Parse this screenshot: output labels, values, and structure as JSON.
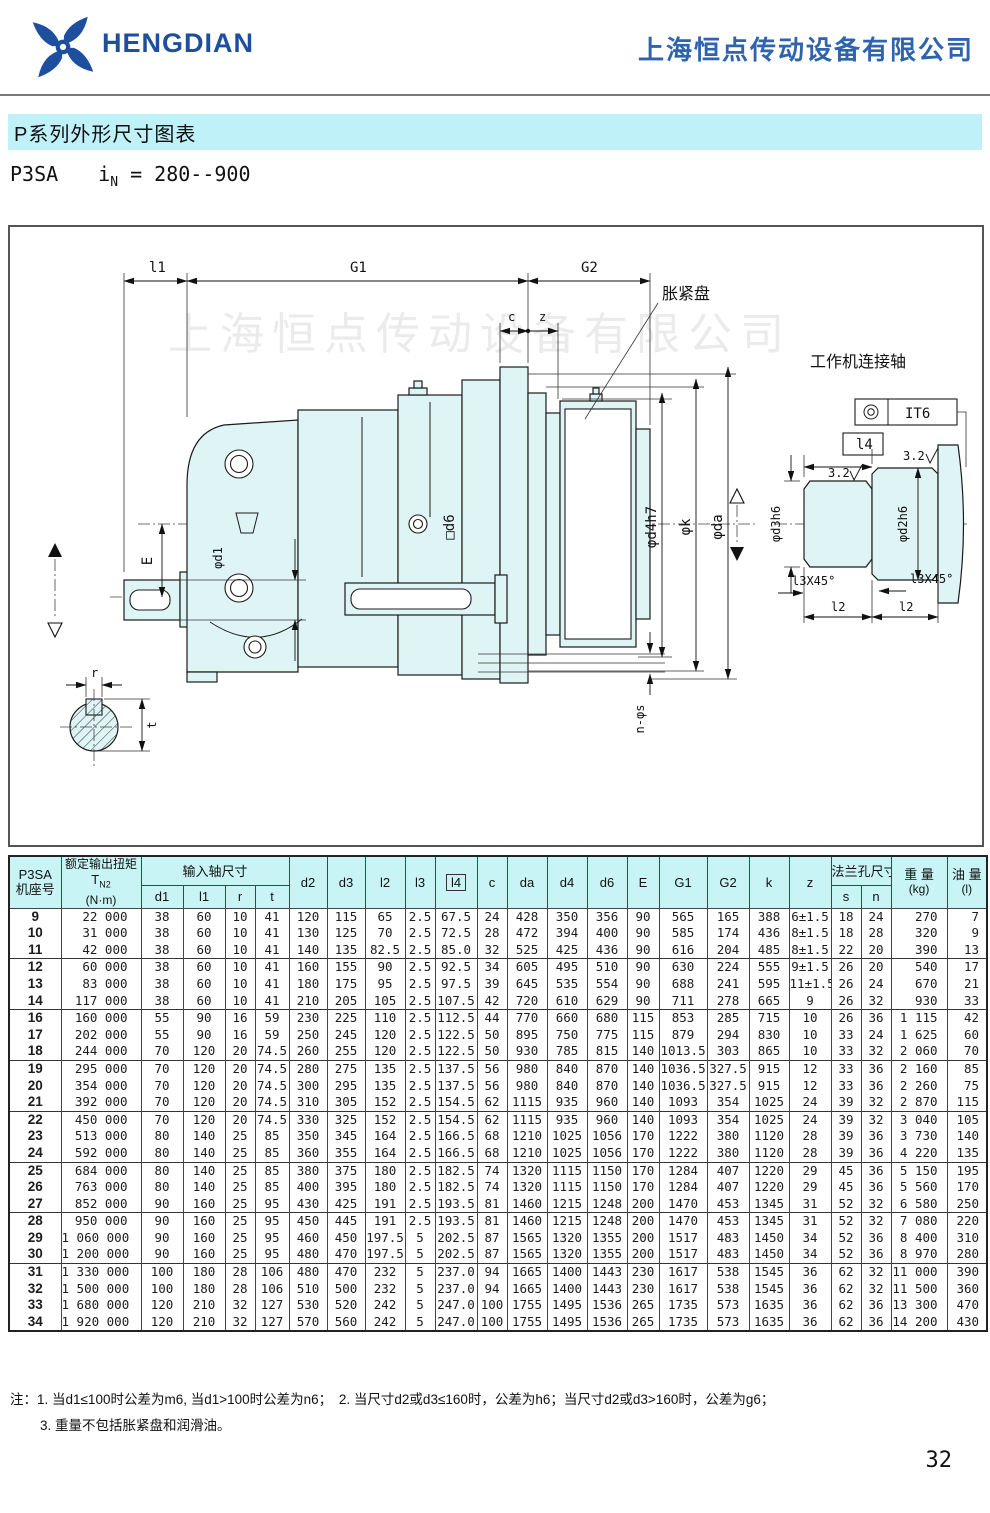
{
  "header": {
    "logo_text": "HENGDIAN",
    "company_name": "上海恒点传动设备有限公司"
  },
  "title_bar": {
    "title": "P系列外形尺寸图表"
  },
  "subtitle": {
    "model": "P3SA",
    "ratio_prefix": "i",
    "ratio_sub": "N",
    "ratio_value": "= 280--900"
  },
  "drawing": {
    "watermark": "上海恒点传动设备有限公司",
    "labels": {
      "l1": "l1",
      "G1": "G1",
      "G2": "G2",
      "c": "c",
      "z": "z",
      "expansion_disc": "胀紧盘",
      "work_shaft": "工作机连接轴",
      "E": "E",
      "d1": "φd1",
      "d6": "□d6",
      "d4h7": "φd4h7",
      "k": "φk",
      "da": "φda",
      "ns": "n-φs",
      "r": "r",
      "t": "t",
      "it6": "IT6",
      "l4": "l4",
      "rough_left": "3.2",
      "rough_right": "3.2",
      "d3h6": "φd3h6",
      "d2h6": "φd2h6",
      "chamfer_left": "l3X45°",
      "chamfer_right": "l3X45°",
      "l2_left": "l2",
      "l2_right": "l2"
    }
  },
  "table": {
    "header": {
      "col1_line1": "P3SA",
      "col1_line2": "机座号",
      "col2_line1": "额定输出扭矩",
      "col2_sym": "T",
      "col2_sub": "N2",
      "col2_unit": "(N·m)",
      "input_group": "输入轴尺寸",
      "d1": "d1",
      "l1": "l1",
      "r": "r",
      "t": "t",
      "d2": "d2",
      "d3": "d3",
      "l2": "l2",
      "l3": "l3",
      "l4": "l4",
      "c": "c",
      "da": "da",
      "d4": "d4",
      "d6": "d6",
      "E": "E",
      "G1": "G1",
      "G2": "G2",
      "k": "k",
      "z": "z",
      "flange_group": "法兰孔尺寸",
      "s": "s",
      "n": "n",
      "weight_line1": "重 量",
      "weight_line2": "(kg)",
      "oil_line1": "油 量",
      "oil_line2": "(l)"
    },
    "col_widths": [
      52,
      80,
      42,
      42,
      30,
      34,
      38,
      38,
      40,
      30,
      42,
      30,
      40,
      40,
      40,
      32,
      48,
      42,
      40,
      42,
      30,
      30,
      56,
      40
    ],
    "group_starts": [
      "9",
      "12",
      "16",
      "19",
      "22",
      "25",
      "28",
      "31"
    ],
    "rows": [
      [
        "9",
        "22 000",
        "38",
        "60",
        "10",
        "41",
        "120",
        "115",
        "65",
        "2.5",
        "67.5",
        "24",
        "428",
        "350",
        "356",
        "90",
        "565",
        "165",
        "388",
        "6±1.5",
        "18",
        "24",
        "270",
        "7"
      ],
      [
        "10",
        "31 000",
        "38",
        "60",
        "10",
        "41",
        "130",
        "125",
        "70",
        "2.5",
        "72.5",
        "28",
        "472",
        "394",
        "400",
        "90",
        "585",
        "174",
        "436",
        "8±1.5",
        "18",
        "28",
        "320",
        "9"
      ],
      [
        "11",
        "42 000",
        "38",
        "60",
        "10",
        "41",
        "140",
        "135",
        "82.5",
        "2.5",
        "85.0",
        "32",
        "525",
        "425",
        "436",
        "90",
        "616",
        "204",
        "485",
        "8±1.5",
        "22",
        "20",
        "390",
        "13"
      ],
      [
        "12",
        "60 000",
        "38",
        "60",
        "10",
        "41",
        "160",
        "155",
        "90",
        "2.5",
        "92.5",
        "34",
        "605",
        "495",
        "510",
        "90",
        "630",
        "224",
        "555",
        "9±1.5",
        "26",
        "20",
        "540",
        "17"
      ],
      [
        "13",
        "83 000",
        "38",
        "60",
        "10",
        "41",
        "180",
        "175",
        "95",
        "2.5",
        "97.5",
        "39",
        "645",
        "535",
        "554",
        "90",
        "688",
        "241",
        "595",
        "11±1.5",
        "26",
        "24",
        "670",
        "21"
      ],
      [
        "14",
        "117 000",
        "38",
        "60",
        "10",
        "41",
        "210",
        "205",
        "105",
        "2.5",
        "107.5",
        "42",
        "720",
        "610",
        "629",
        "90",
        "711",
        "278",
        "665",
        "9",
        "26",
        "32",
        "930",
        "33"
      ],
      [
        "16",
        "160 000",
        "55",
        "90",
        "16",
        "59",
        "230",
        "225",
        "110",
        "2.5",
        "112.5",
        "44",
        "770",
        "660",
        "680",
        "115",
        "853",
        "285",
        "715",
        "10",
        "26",
        "36",
        "1 115",
        "42"
      ],
      [
        "17",
        "202 000",
        "55",
        "90",
        "16",
        "59",
        "250",
        "245",
        "120",
        "2.5",
        "122.5",
        "50",
        "895",
        "750",
        "775",
        "115",
        "879",
        "294",
        "830",
        "10",
        "33",
        "24",
        "1 625",
        "60"
      ],
      [
        "18",
        "244 000",
        "70",
        "120",
        "20",
        "74.5",
        "260",
        "255",
        "120",
        "2.5",
        "122.5",
        "50",
        "930",
        "785",
        "815",
        "140",
        "1013.5",
        "303",
        "865",
        "10",
        "33",
        "32",
        "2 060",
        "70"
      ],
      [
        "19",
        "295 000",
        "70",
        "120",
        "20",
        "74.5",
        "280",
        "275",
        "135",
        "2.5",
        "137.5",
        "56",
        "980",
        "840",
        "870",
        "140",
        "1036.5",
        "327.5",
        "915",
        "12",
        "33",
        "36",
        "2 160",
        "85"
      ],
      [
        "20",
        "354 000",
        "70",
        "120",
        "20",
        "74.5",
        "300",
        "295",
        "135",
        "2.5",
        "137.5",
        "56",
        "980",
        "840",
        "870",
        "140",
        "1036.5",
        "327.5",
        "915",
        "12",
        "33",
        "36",
        "2 260",
        "75"
      ],
      [
        "21",
        "392 000",
        "70",
        "120",
        "20",
        "74.5",
        "310",
        "305",
        "152",
        "2.5",
        "154.5",
        "62",
        "1115",
        "935",
        "960",
        "140",
        "1093",
        "354",
        "1025",
        "24",
        "39",
        "32",
        "2 870",
        "115"
      ],
      [
        "22",
        "450 000",
        "70",
        "120",
        "20",
        "74.5",
        "330",
        "325",
        "152",
        "2.5",
        "154.5",
        "62",
        "1115",
        "935",
        "960",
        "140",
        "1093",
        "354",
        "1025",
        "24",
        "39",
        "32",
        "3 040",
        "105"
      ],
      [
        "23",
        "513 000",
        "80",
        "140",
        "25",
        "85",
        "350",
        "345",
        "164",
        "2.5",
        "166.5",
        "68",
        "1210",
        "1025",
        "1056",
        "170",
        "1222",
        "380",
        "1120",
        "28",
        "39",
        "36",
        "3 730",
        "140"
      ],
      [
        "24",
        "592 000",
        "80",
        "140",
        "25",
        "85",
        "360",
        "355",
        "164",
        "2.5",
        "166.5",
        "68",
        "1210",
        "1025",
        "1056",
        "170",
        "1222",
        "380",
        "1120",
        "28",
        "39",
        "36",
        "4 220",
        "135"
      ],
      [
        "25",
        "684 000",
        "80",
        "140",
        "25",
        "85",
        "380",
        "375",
        "180",
        "2.5",
        "182.5",
        "74",
        "1320",
        "1115",
        "1150",
        "170",
        "1284",
        "407",
        "1220",
        "29",
        "45",
        "36",
        "5 150",
        "195"
      ],
      [
        "26",
        "763 000",
        "80",
        "140",
        "25",
        "85",
        "400",
        "395",
        "180",
        "2.5",
        "182.5",
        "74",
        "1320",
        "1115",
        "1150",
        "170",
        "1284",
        "407",
        "1220",
        "29",
        "45",
        "36",
        "5 560",
        "170"
      ],
      [
        "27",
        "852 000",
        "90",
        "160",
        "25",
        "95",
        "430",
        "425",
        "191",
        "2.5",
        "193.5",
        "81",
        "1460",
        "1215",
        "1248",
        "200",
        "1470",
        "453",
        "1345",
        "31",
        "52",
        "32",
        "6 580",
        "250"
      ],
      [
        "28",
        "950 000",
        "90",
        "160",
        "25",
        "95",
        "450",
        "445",
        "191",
        "2.5",
        "193.5",
        "81",
        "1460",
        "1215",
        "1248",
        "200",
        "1470",
        "453",
        "1345",
        "31",
        "52",
        "32",
        "7 080",
        "220"
      ],
      [
        "29",
        "1 060 000",
        "90",
        "160",
        "25",
        "95",
        "460",
        "450",
        "197.5",
        "5",
        "202.5",
        "87",
        "1565",
        "1320",
        "1355",
        "200",
        "1517",
        "483",
        "1450",
        "34",
        "52",
        "36",
        "8 400",
        "310"
      ],
      [
        "30",
        "1 200 000",
        "90",
        "160",
        "25",
        "95",
        "480",
        "470",
        "197.5",
        "5",
        "202.5",
        "87",
        "1565",
        "1320",
        "1355",
        "200",
        "1517",
        "483",
        "1450",
        "34",
        "52",
        "36",
        "8 970",
        "280"
      ],
      [
        "31",
        "1 330 000",
        "100",
        "180",
        "28",
        "106",
        "480",
        "470",
        "232",
        "5",
        "237.0",
        "94",
        "1665",
        "1400",
        "1443",
        "230",
        "1617",
        "538",
        "1545",
        "36",
        "62",
        "32",
        "11 000",
        "390"
      ],
      [
        "32",
        "1 500 000",
        "100",
        "180",
        "28",
        "106",
        "510",
        "500",
        "232",
        "5",
        "237.0",
        "94",
        "1665",
        "1400",
        "1443",
        "230",
        "1617",
        "538",
        "1545",
        "36",
        "62",
        "32",
        "11 500",
        "360"
      ],
      [
        "33",
        "1 680 000",
        "120",
        "210",
        "32",
        "127",
        "530",
        "520",
        "242",
        "5",
        "247.0",
        "100",
        "1755",
        "1495",
        "1536",
        "265",
        "1735",
        "573",
        "1635",
        "36",
        "62",
        "36",
        "13 300",
        "470"
      ],
      [
        "34",
        "1 920 000",
        "120",
        "210",
        "32",
        "127",
        "570",
        "560",
        "242",
        "5",
        "247.0",
        "100",
        "1755",
        "1495",
        "1536",
        "265",
        "1735",
        "573",
        "1635",
        "36",
        "62",
        "36",
        "14 200",
        "430"
      ]
    ]
  },
  "notes": {
    "label": "注：",
    "line1": "1. 当d1≤100时公差为m6, 当d1>100时公差为n6；　2. 当尺寸d2或d3≤160时，公差为h6；当尺寸d2或d3>160时，公差为g6；",
    "line2": "3. 重量不包括胀紧盘和润滑油。"
  },
  "page": {
    "number": "32"
  },
  "colors": {
    "accent_blue": "#1e4f9e",
    "company_blue": "#2e63ae",
    "title_bar_bg": "#bff2f8",
    "table_header_bg": "#c9f4f6",
    "drawing_fill": "#dff4f4"
  }
}
